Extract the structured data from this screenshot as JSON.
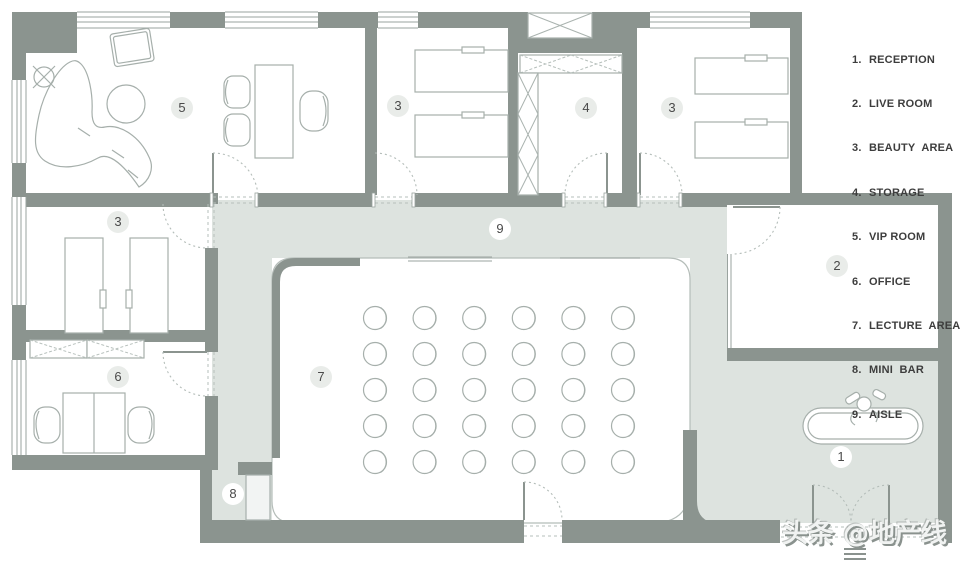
{
  "legend": {
    "items": [
      {
        "num": "1.",
        "label": "RECEPTION"
      },
      {
        "num": "2.",
        "label": "LIVE ROOM"
      },
      {
        "num": "3.",
        "label": "BEAUTY  AREA"
      },
      {
        "num": "4.",
        "label": "STORAGE"
      },
      {
        "num": "5.",
        "label": "VIP ROOM"
      },
      {
        "num": "6.",
        "label": "OFFICE"
      },
      {
        "num": "7.",
        "label": "LECTURE  AREA"
      },
      {
        "num": "8.",
        "label": "MINI  BAR"
      },
      {
        "num": "9.",
        "label": "AISLE"
      }
    ]
  },
  "room_labels": [
    {
      "room": "vip-room",
      "num": "5"
    },
    {
      "room": "beauty-area-middle",
      "num": "3"
    },
    {
      "room": "storage",
      "num": "4"
    },
    {
      "room": "beauty-area-right",
      "num": "3"
    },
    {
      "room": "beauty-area-left",
      "num": "3"
    },
    {
      "room": "office",
      "num": "6"
    },
    {
      "room": "aisle",
      "num": "9"
    },
    {
      "room": "lecture-area",
      "num": "7"
    },
    {
      "room": "live-room",
      "num": "2"
    },
    {
      "room": "reception",
      "num": "1"
    },
    {
      "room": "mini-bar",
      "num": "8"
    }
  ],
  "lecture_area": {
    "chair_grid": {
      "rows": 5,
      "cols": 6
    }
  },
  "watermark": {
    "text": "头条 @地产线"
  },
  "colors": {
    "wall": "#8b948f",
    "aisle_floor": "#dde3df",
    "room_floor": "#ffffff",
    "furniture_line": "#a6afab",
    "label_text": "#4a4a4a"
  }
}
